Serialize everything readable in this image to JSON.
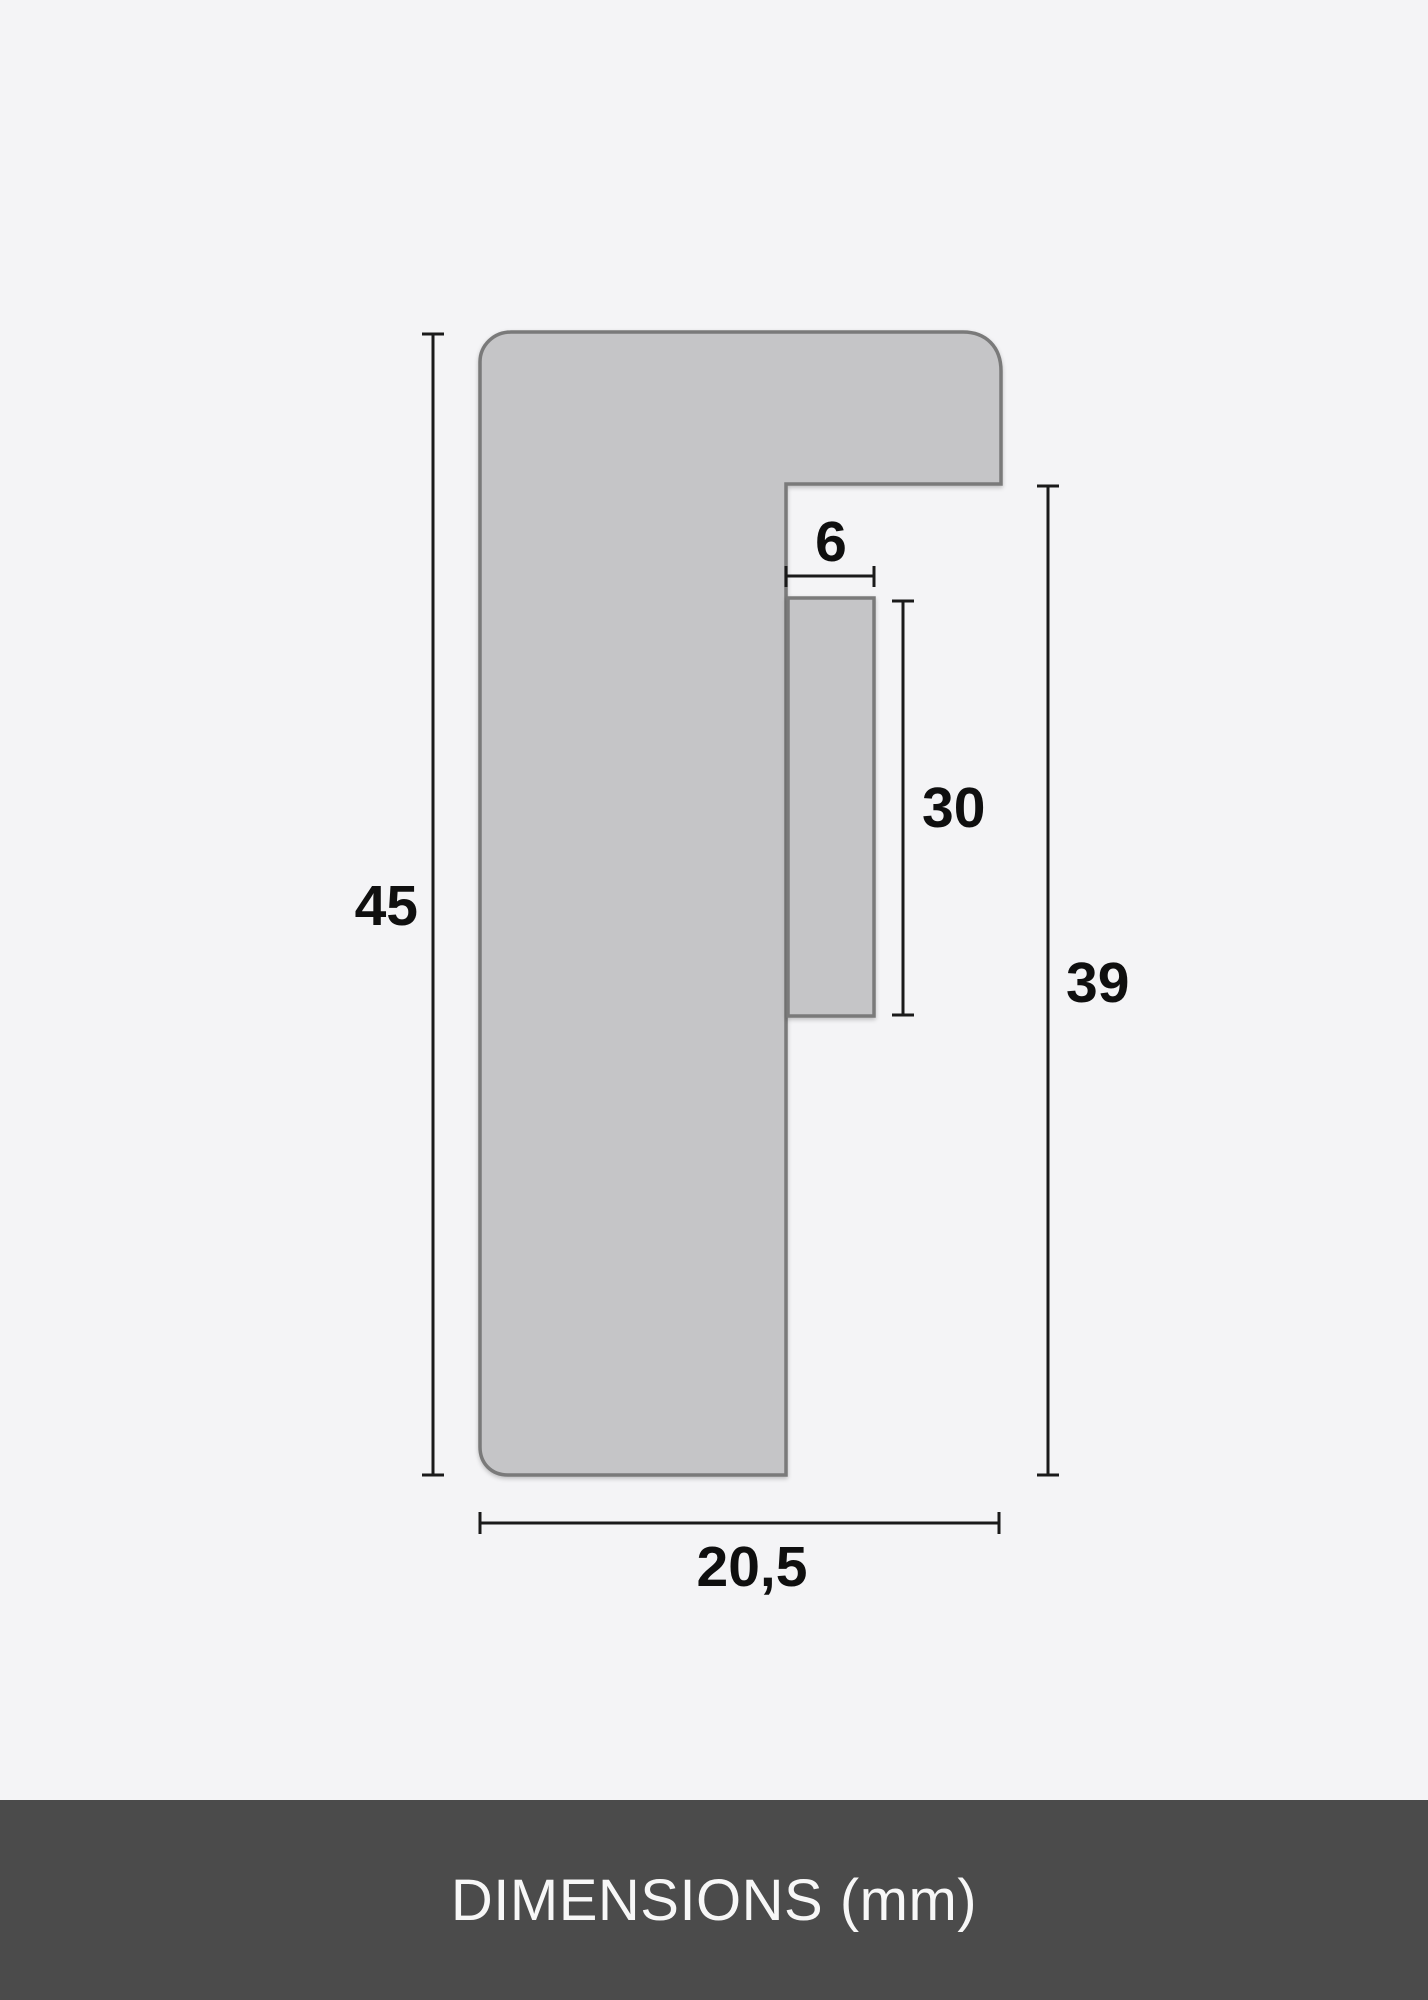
{
  "diagram": {
    "title": "picture-frame-moulding-cross-section",
    "dimensions": [
      {
        "name": "overall-height",
        "value": "45"
      },
      {
        "name": "lip-width",
        "value": "6"
      },
      {
        "name": "lip-depth",
        "value": "30"
      },
      {
        "name": "height-below-top-flange",
        "value": "39"
      },
      {
        "name": "overall-width",
        "value": "20,5"
      }
    ],
    "colors": {
      "background": "#f4f4f6",
      "profile_fill": "#c5c5c7",
      "profile_stroke": "#7a7a7a",
      "dimension_line": "#1a1a1a",
      "label_text": "#0f0f0f"
    }
  },
  "footer": {
    "label": "DIMENSIONS (mm)",
    "background": "#4b4b4b",
    "text_color": "#f7f7f7"
  }
}
